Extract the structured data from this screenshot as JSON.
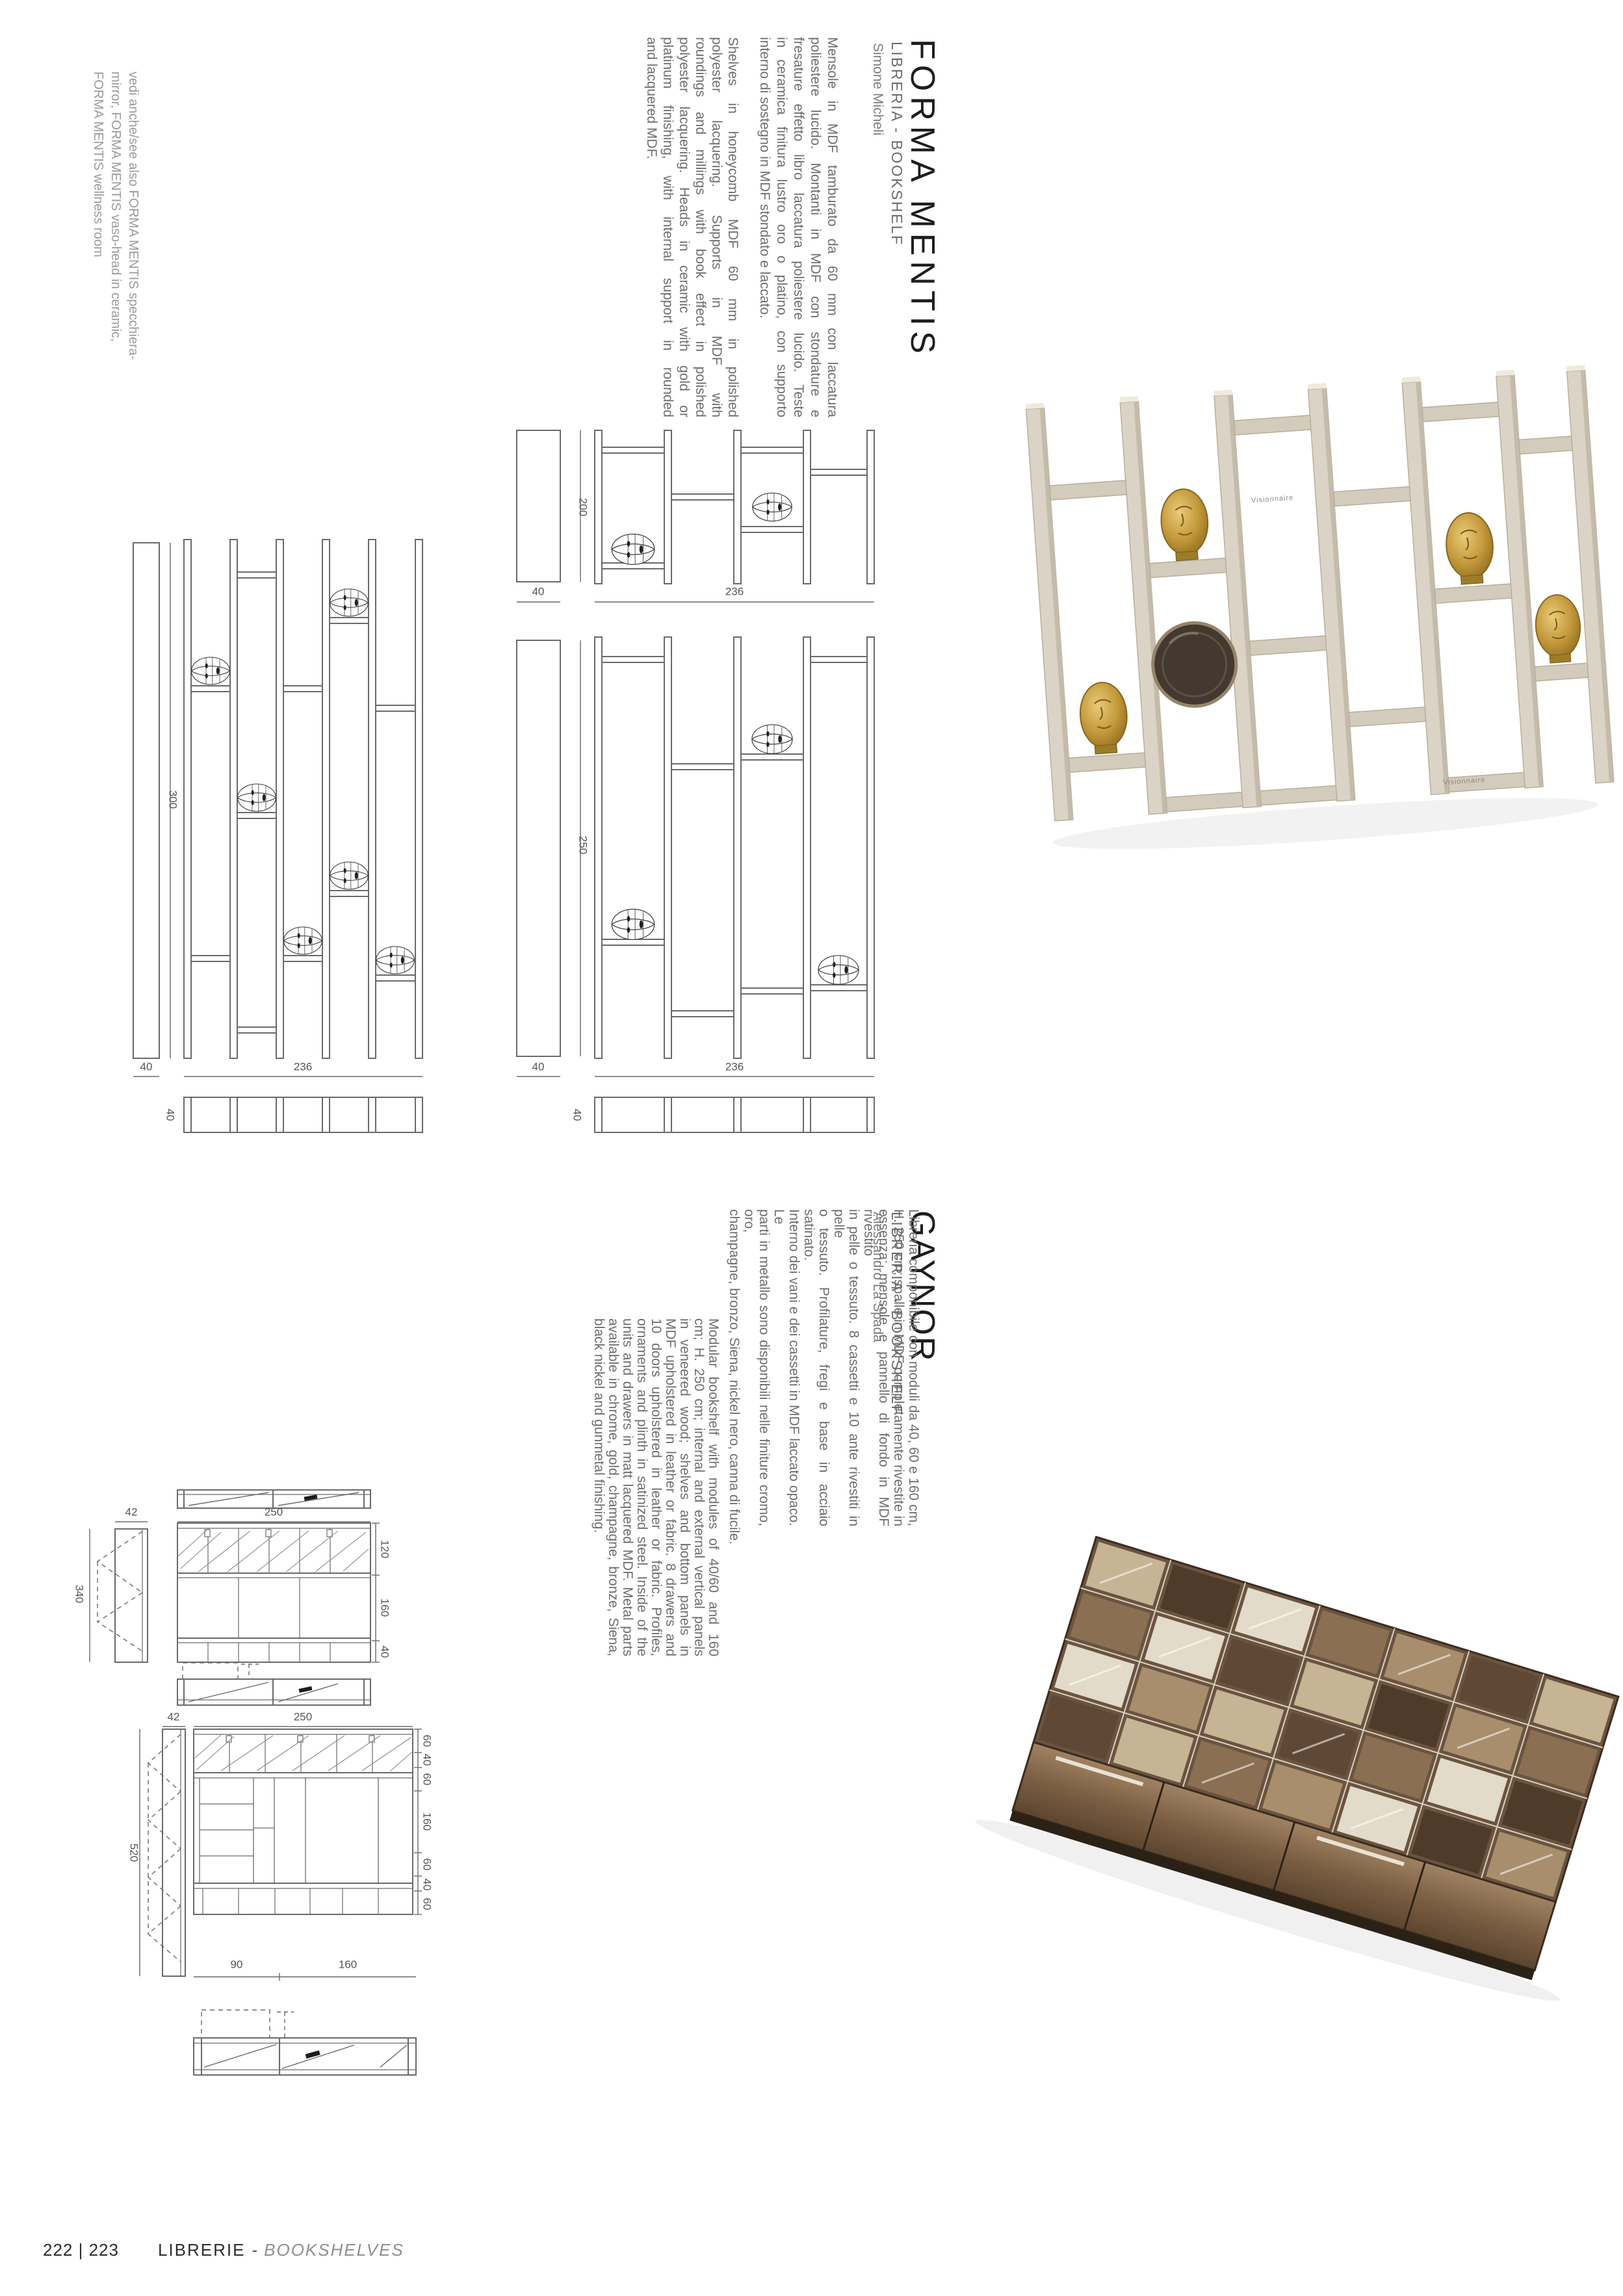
{
  "forma_mentis": {
    "title": "FORMA MENTIS",
    "subtitle": "LIBRERIA - BOOKSHELF",
    "designer": "Simone Micheli",
    "note_lines": [
      "vedi anche/see also FORMA MENTIS specchiera-",
      "mirror, FORMA MENTIS vaso-head in ceramic,",
      "FORMA MENTIS wellness room"
    ],
    "desc_it_lines": [
      "Mensole in MDF tamburato da 60 mm con laccatura",
      "poliestere lucido. Montanti in MDF con stondature e",
      "fresature effetto libro laccatura poliestere lucido. Teste",
      "in ceramica finitura lustro oro o platino, con supporto",
      "interno di sostegno in MDF stondato e laccato."
    ],
    "desc_en_lines": [
      "Shelves in honeycomb MDF 60 mm in polished",
      "polyester lacquering. Supports in MDF with",
      "roundings and millings with book effect in polished",
      "polyester lacquering. Heads in ceramic with gold or",
      "platinum finishing, with internal support in rounded",
      "and lacquered MDF."
    ],
    "photo_logo": "Visionnaire",
    "drawings": {
      "set_a": {
        "height": "200",
        "side": "40",
        "width": "236"
      },
      "set_b": {
        "height": "300",
        "side": "40",
        "width": "236",
        "top": "40"
      },
      "set_c": {
        "height": "250",
        "side": "40",
        "width": "236",
        "top": "40"
      }
    }
  },
  "gaynor": {
    "title": "GAYNOR",
    "subtitle": "LIBRERIA - BOOKSHELF",
    "designer": "Alessandro La Spada",
    "desc_it_lines": [
      "Libreria componibile con moduli da 40, 60 e 160 cm,",
      "H. 250 cm; spalle in MDF completamente rivestite in",
      "essenza; mensole e pannello di fondo in MDF rivestito",
      "in pelle o tessuto. 8 cassetti e 10 ante rivestiti in pelle",
      "o tessuto. Profilature, fregi e base in acciaio satinato.",
      "Interno dei vani e dei cassetti in MDF laccato opaco. Le",
      "parti in metallo sono disponibili nelle finiture cromo, oro,",
      "champagne, bronzo, Siena, nickel nero, canna di fucile."
    ],
    "desc_en_lines": [
      "Modular bookshelf with modules of 40/60 and 160",
      "cm; H. 250 cm; internal and external vertical panels",
      "in veneered wood; shelves and bottom panels in",
      "MDF upholstered in leather or fabric. 8 drawers and",
      "10 doors upholstered in leather or fabric. Profiles,",
      "ornaments and plinth in satinized steel. Inside of the",
      "units and drawers in matt lacquered MDF. Metal parts",
      "available in chrome, gold, champagne, bronze, Siena,",
      "black nickel and gunmetal finishing."
    ],
    "drawings": {
      "group1": {
        "depth": "42",
        "width": "250",
        "side": "340",
        "sections": [
          "120",
          "160",
          "40"
        ]
      },
      "group2": {
        "depth": "42",
        "width": "250",
        "side": "520",
        "sections": [
          "60",
          "40",
          "60",
          "160",
          "60",
          "40",
          "60"
        ],
        "bottom": [
          "90",
          "160"
        ]
      }
    }
  },
  "footer": {
    "pages": "222 | 223",
    "section_it": "LIBRERIE",
    "separator": "-",
    "section_en": "BOOKSHELVES"
  },
  "colors": {
    "line": "#6a6a6a",
    "dim_text": "#565656",
    "gold": "#b98a2e",
    "cream": "#dbd4c6",
    "marble_dark": "#5a4431",
    "marble_light": "#c7b494"
  }
}
